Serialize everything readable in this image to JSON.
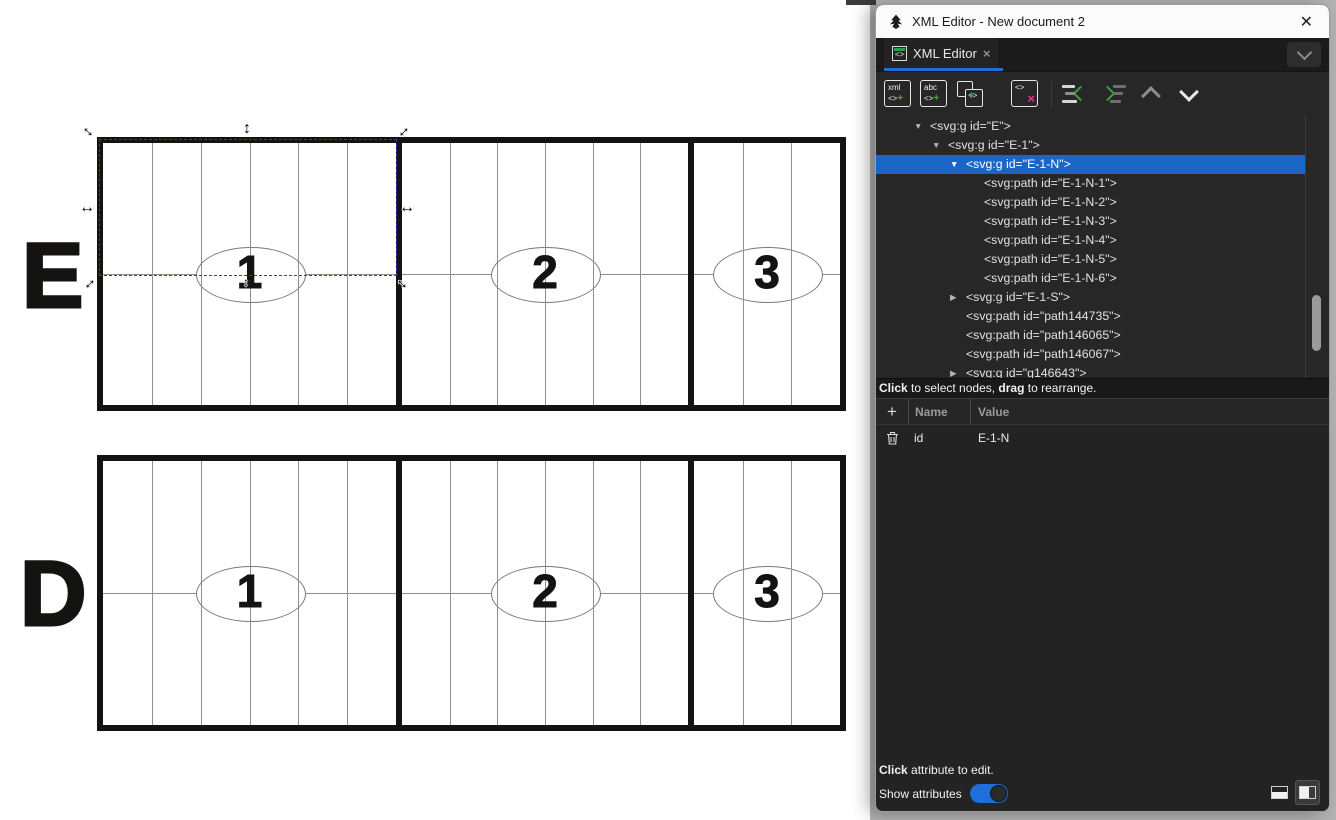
{
  "window": {
    "title": "XML Editor - New document 2",
    "close_glyph": "✕",
    "icons": {
      "app": "inkscape-logo"
    }
  },
  "tab": {
    "label": "XML Editor",
    "close_glyph": "×",
    "icon_glyph": "<>"
  },
  "toolbar": {
    "new_element": {
      "line1": "xml",
      "line2": "<>",
      "plus": "+"
    },
    "new_text": {
      "line1": "abc",
      "line2": "<>",
      "plus": "+"
    },
    "duplicate": {
      "tag": "<>",
      "plus": "+"
    },
    "delete": {
      "tag": "<>",
      "x": "×"
    }
  },
  "xml_tree": {
    "nodes": [
      {
        "indent": 0,
        "expander": "open",
        "text": "<svg:g id=\"E\">",
        "selected": false
      },
      {
        "indent": 1,
        "expander": "open",
        "text": "<svg:g id=\"E-1\">",
        "selected": false
      },
      {
        "indent": 2,
        "expander": "open",
        "text": "<svg:g id=\"E-1-N\">",
        "selected": true
      },
      {
        "indent": 3,
        "expander": null,
        "text": "<svg:path id=\"E-1-N-1\">",
        "selected": false
      },
      {
        "indent": 3,
        "expander": null,
        "text": "<svg:path id=\"E-1-N-2\">",
        "selected": false
      },
      {
        "indent": 3,
        "expander": null,
        "text": "<svg:path id=\"E-1-N-3\">",
        "selected": false
      },
      {
        "indent": 3,
        "expander": null,
        "text": "<svg:path id=\"E-1-N-4\">",
        "selected": false
      },
      {
        "indent": 3,
        "expander": null,
        "text": "<svg:path id=\"E-1-N-5\">",
        "selected": false
      },
      {
        "indent": 3,
        "expander": null,
        "text": "<svg:path id=\"E-1-N-6\">",
        "selected": false
      },
      {
        "indent": 2,
        "expander": "closed",
        "text": "<svg:g id=\"E-1-S\">",
        "selected": false
      },
      {
        "indent": 2,
        "expander": null,
        "text": "<svg:path id=\"path144735\">",
        "selected": false
      },
      {
        "indent": 2,
        "expander": null,
        "text": "<svg:path id=\"path146065\">",
        "selected": false
      },
      {
        "indent": 2,
        "expander": null,
        "text": "<svg:path id=\"path146067\">",
        "selected": false
      },
      {
        "indent": 2,
        "expander": "closed",
        "text": "<svg:g id=\"g146643\">",
        "selected": false
      }
    ]
  },
  "tree_hint": {
    "b1": "Click",
    "mid": " to select nodes, ",
    "b2": "drag",
    "tail": " to rearrange."
  },
  "attributes": {
    "add_glyph": "+",
    "header": {
      "name": "Name",
      "value": "Value"
    },
    "rows": [
      {
        "name": "id",
        "value": "E-1-N"
      }
    ],
    "hint_bold": "Click",
    "hint_rest": " attribute to edit.",
    "show_label": "Show attributes",
    "show_attributes_on": true
  },
  "colors": {
    "accent_blue": "#1f6fd4",
    "selection_blue": "#1a66c6",
    "delete_magenta": "#f0368e",
    "add_green": "#35b04a",
    "canvas_dash_blue": "#3434c8"
  },
  "canvas": {
    "rows": [
      {
        "label": "E",
        "sections": [
          {
            "number": "1"
          },
          {
            "number": "2"
          },
          {
            "number": "3"
          }
        ]
      },
      {
        "label": "D",
        "sections": [
          {
            "number": "1"
          },
          {
            "number": "2"
          },
          {
            "number": "3"
          }
        ]
      }
    ],
    "selection_target": "E-1-N"
  }
}
